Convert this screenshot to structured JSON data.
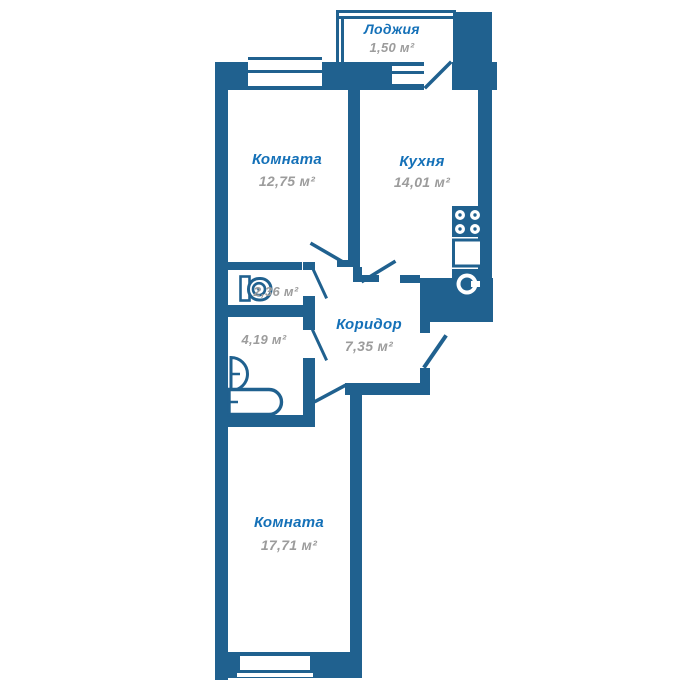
{
  "title": "Apartment floor plan",
  "colors": {
    "wall": "#20618f",
    "label": "#1571b8",
    "area_text": "#9c9c9c",
    "background": "#ffffff"
  },
  "rooms": {
    "loggia": {
      "name": "Лоджия",
      "area": "1,50 м²"
    },
    "room1": {
      "name": "Комната",
      "area": "12,75 м²"
    },
    "kitchen": {
      "name": "Кухня",
      "area": "14,01 м²"
    },
    "wc": {
      "area": "2,36 м²"
    },
    "bathroom": {
      "area": "4,19 м²"
    },
    "corridor": {
      "name": "Коридор",
      "area": "7,35 м²"
    },
    "room2": {
      "name": "Комната",
      "area": "17,71 м²"
    }
  },
  "icons": [
    "stove-icon",
    "kitchen-counter-icon",
    "kitchen-sink-icon",
    "toilet-icon",
    "washbasin-icon",
    "bathtub-icon",
    "window-icon",
    "door-swing-icon"
  ]
}
